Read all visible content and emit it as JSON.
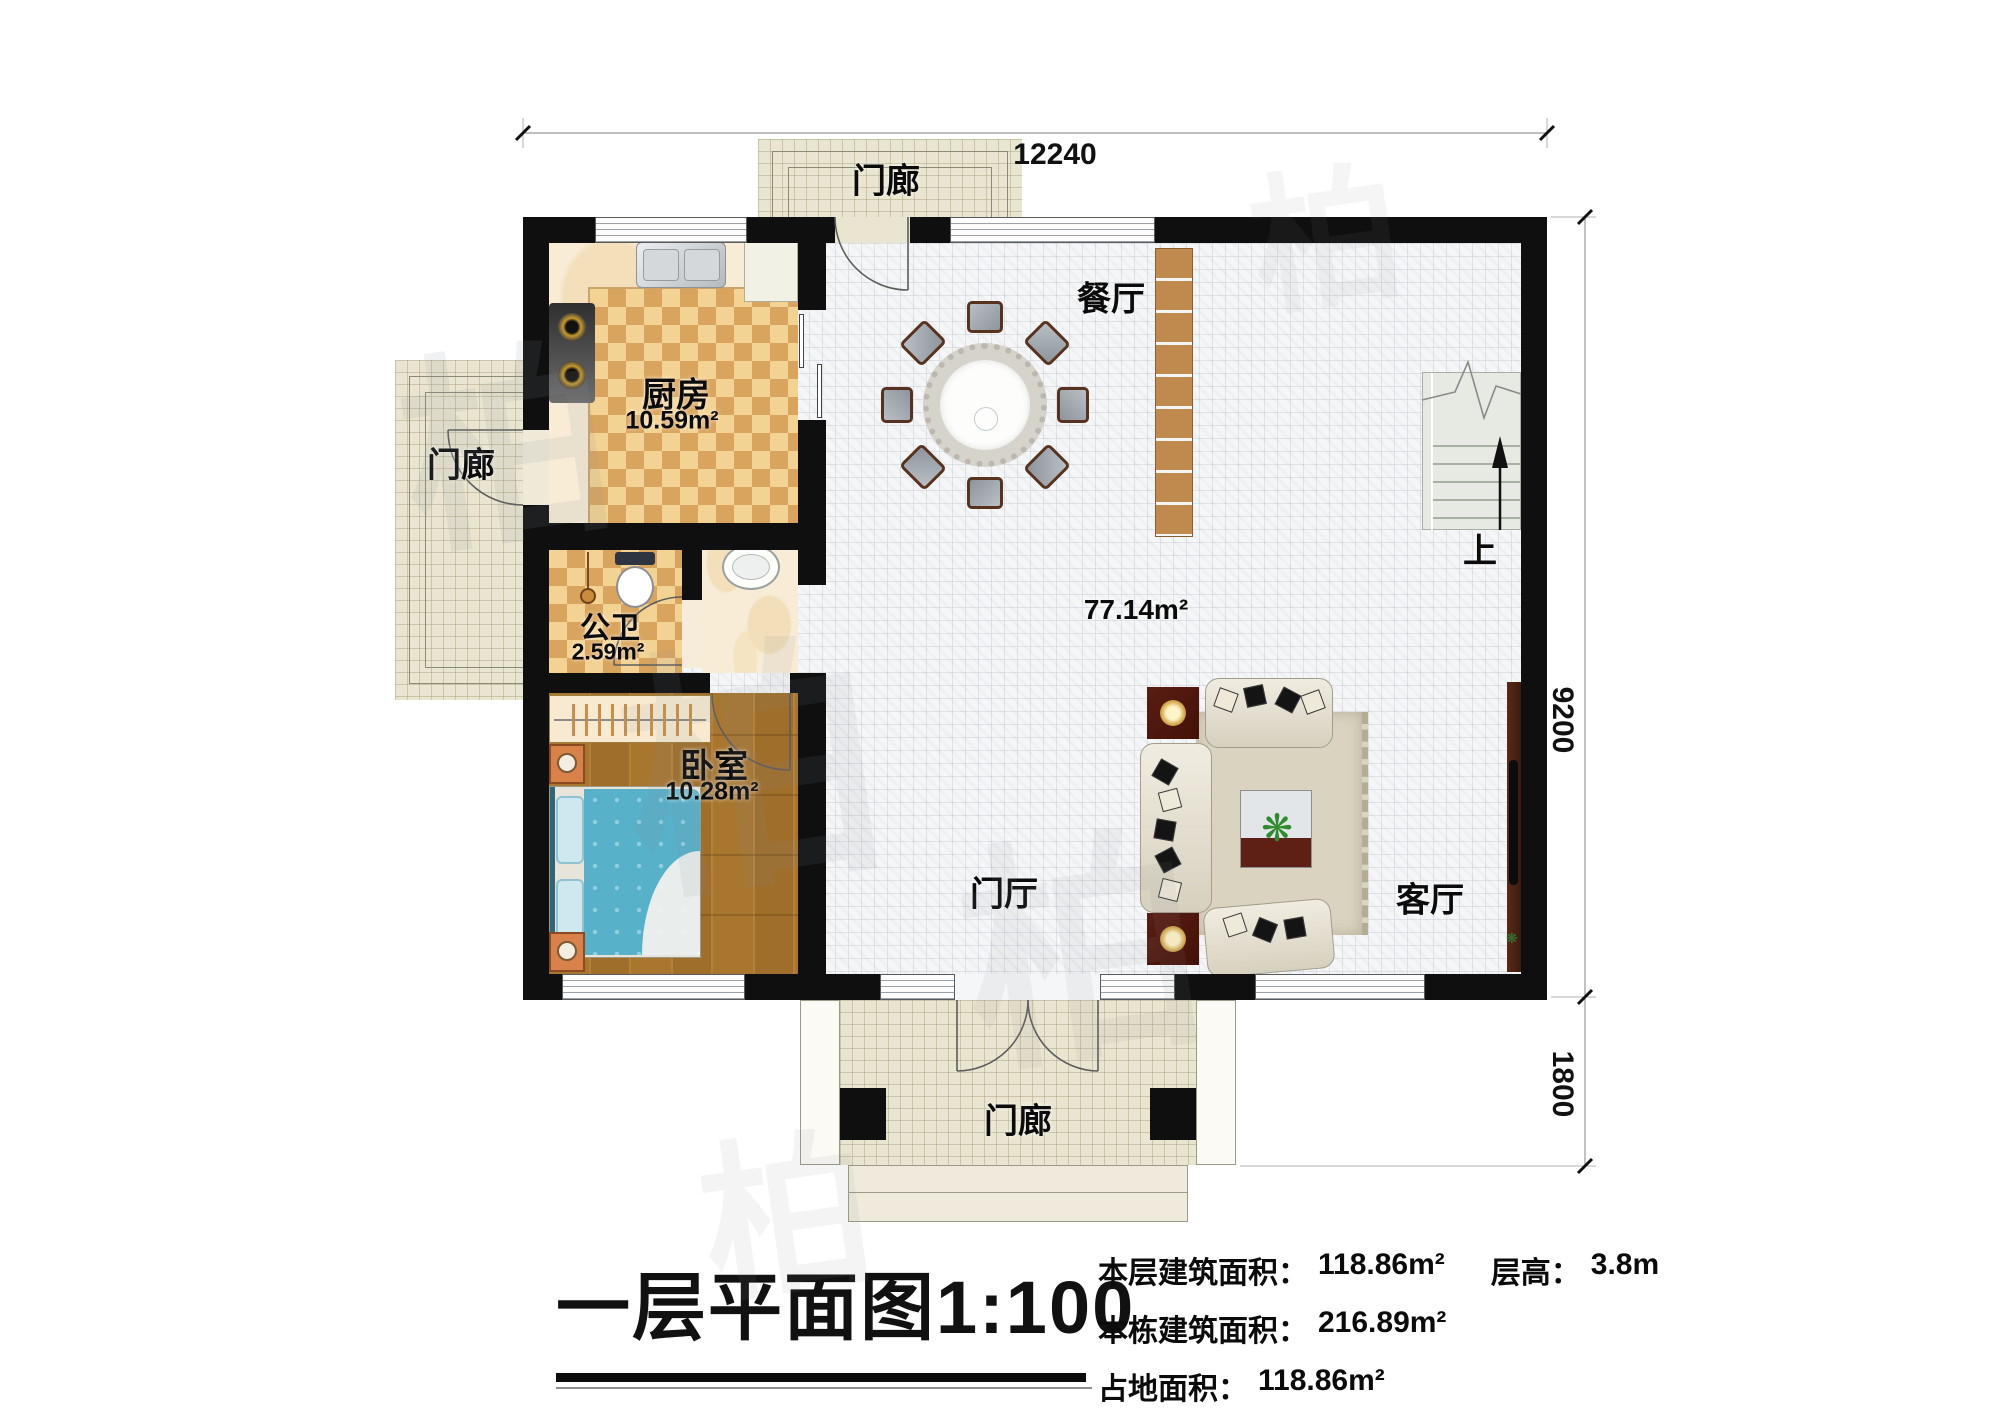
{
  "plan": {
    "dimensions": {
      "top_width": "12240",
      "right_height": "9200",
      "porch_depth": "1800"
    },
    "rooms": {
      "porch_top": {
        "name": "门廊"
      },
      "porch_left": {
        "name": "门廊"
      },
      "porch_bottom": {
        "name": "门廊"
      },
      "kitchen": {
        "name": "厨房",
        "area": "10.59m²"
      },
      "bath": {
        "name": "公卫",
        "area": "2.59m²"
      },
      "bedroom": {
        "name": "卧室",
        "area": "10.28m²"
      },
      "dining": {
        "name": "餐厅"
      },
      "living": {
        "name": "客厅"
      },
      "foyer": {
        "name": "门厅"
      },
      "hall_area": "77.14m²",
      "stairs_up": "上"
    },
    "title_block": {
      "title": "一层平面图",
      "scale": "1:100",
      "stats": {
        "floor_area_label": "本层建筑面积：",
        "floor_area": "118.86m²",
        "height_label": "层高：",
        "height": "3.8m",
        "total_area_label": "本栋建筑面积：",
        "total_area": "216.89m²",
        "footprint_label": "占地面积：",
        "footprint": "118.86m²"
      }
    },
    "watermark": "柏",
    "colors": {
      "wall": "#0f0f0f",
      "kitchen_tile": "#d9a55e",
      "bedroom_wood": "#a8762f",
      "quilt_blue": "#57b1c9",
      "cabinet_wood": "#c08a4e",
      "porch_tile": "#eae5d0"
    }
  }
}
